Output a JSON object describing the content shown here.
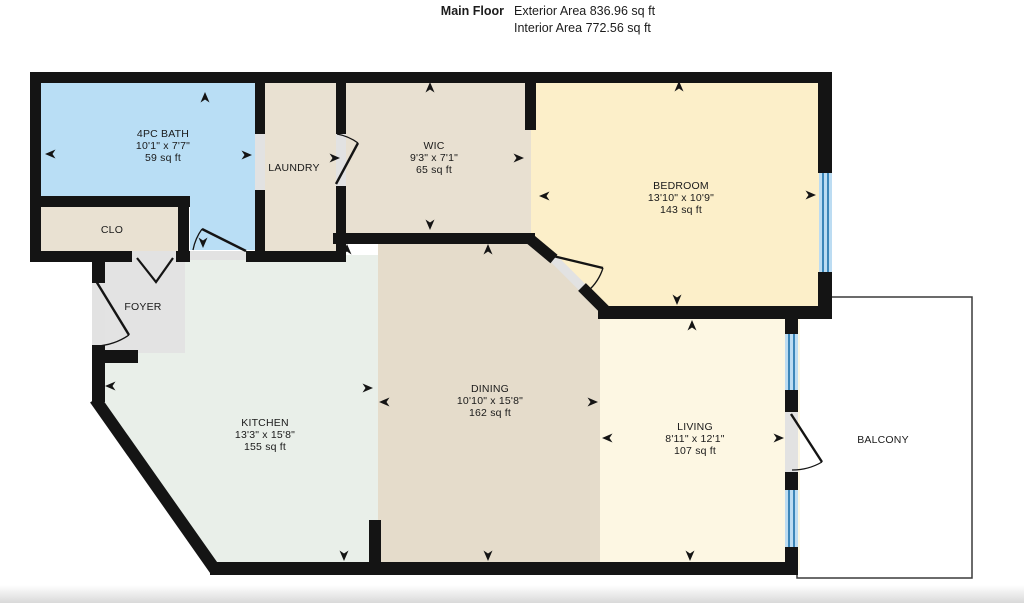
{
  "header": {
    "title": "Main Floor",
    "exterior_area": "Exterior Area 836.96 sq ft",
    "interior_area": "Interior Area 772.56 sq ft"
  },
  "rooms": {
    "bath": {
      "name": "4PC BATH",
      "dims": "10'1\" x 7'7\"",
      "area": "59 sq ft"
    },
    "clo": {
      "name": "CLO"
    },
    "laundry": {
      "name": "LAUNDRY"
    },
    "wic": {
      "name": "WIC",
      "dims": "9'3\" x 7'1\"",
      "area": "65 sq ft"
    },
    "bedroom": {
      "name": "BEDROOM",
      "dims": "13'10\" x 10'9\"",
      "area": "143 sq ft"
    },
    "foyer": {
      "name": "FOYER"
    },
    "kitchen": {
      "name": "KITCHEN",
      "dims": "13'3\" x 15'8\"",
      "area": "155 sq ft"
    },
    "dining": {
      "name": "DINING",
      "dims": "10'10\" x 15'8\"",
      "area": "162 sq ft"
    },
    "living": {
      "name": "LIVING",
      "dims": "8'11\" x 12'1\"",
      "area": "107 sq ft"
    },
    "balcony": {
      "name": "BALCONY"
    }
  },
  "colors": {
    "wall": "#141414",
    "bath_fill": "#b9def5",
    "closet_fill": "#e9e1d2",
    "laundry_fill": "#e9e1d2",
    "wic_fill": "#e8e0d1",
    "bedroom_fill": "#fcefc9",
    "foyer_fill": "#e3e3e3",
    "kitchen_fill": "#e9efe9",
    "dining_fill": "#e5dccb",
    "living_fill": "#fdf7e3",
    "balcony_fill": "#ffffff",
    "balcony_border": "#3a3a3a",
    "window_fill": "#bcdcf2",
    "window_line": "#3c86b8",
    "door_opening": "#e2e2e2"
  }
}
